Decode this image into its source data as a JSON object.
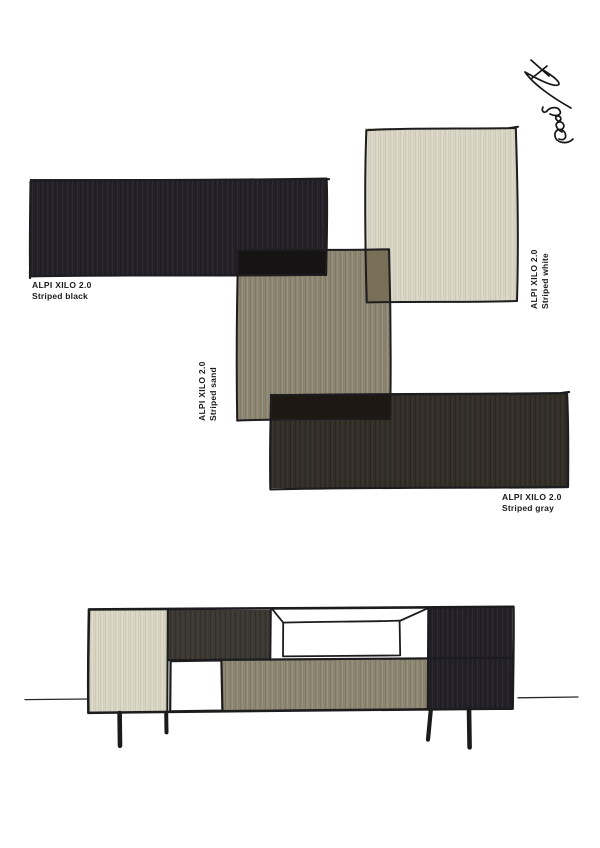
{
  "page": {
    "background": "#ffffff"
  },
  "brand_line": "ALPI XILO 2.0",
  "swatches": [
    {
      "id": "striped-black",
      "product": "ALPI XILO 2.0",
      "finish": "Striped black",
      "color": "#26242a",
      "label_orientation": "horizontal"
    },
    {
      "id": "striped-sand",
      "product": "ALPI XILO 2.0",
      "finish": "Striped sand",
      "color": "#8e8773",
      "label_orientation": "vertical"
    },
    {
      "id": "striped-white",
      "product": "ALPI XILO 2.0",
      "finish": "Striped white",
      "color": "#d9d5c4",
      "label_orientation": "vertical"
    },
    {
      "id": "striped-gray",
      "product": "ALPI XILO 2.0",
      "finish": "Striped gray",
      "color": "#343029",
      "label_orientation": "horizontal"
    }
  ],
  "overlap_colors": {
    "sand_on_black": "#151313",
    "white_on_sand": "#786f58",
    "gray_on_sand": "#1d1912"
  },
  "signature_icon": "handwritten-designer-signature",
  "illustration": {
    "type": "sideboard-sketch",
    "panels": [
      "striped-white",
      "striped-gray",
      "open-shelf",
      "striped-black",
      "striped-sand"
    ],
    "line_color": "#1c1c1e"
  }
}
